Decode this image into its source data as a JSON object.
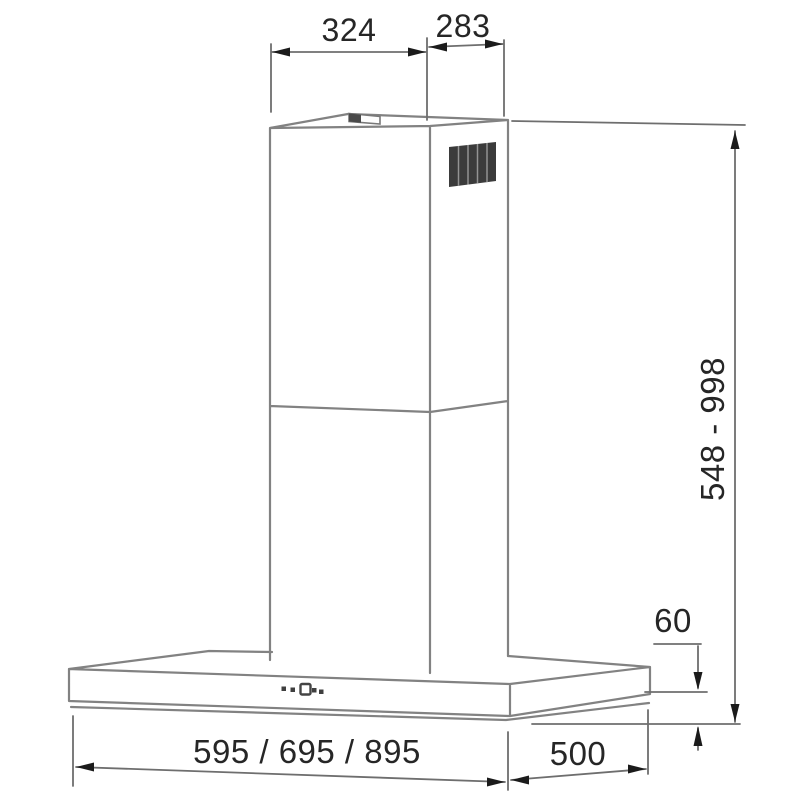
{
  "diagram": {
    "labels": {
      "top_width": "324",
      "top_depth": "283",
      "height_range": "548 - 998",
      "edge_height": "60",
      "body_widths": "595 / 695 / 895",
      "body_depth": "500"
    },
    "colors": {
      "background": "#ffffff",
      "line": "#828282",
      "dim_line": "#6e6e6e",
      "arrow": "#1b1b1b",
      "text": "#262626",
      "grille_fill": "#3b3b3b",
      "grille_slat": "#939393",
      "button_fill": "#3f3f3f",
      "outlet_fill": "#4a4a4a"
    }
  }
}
